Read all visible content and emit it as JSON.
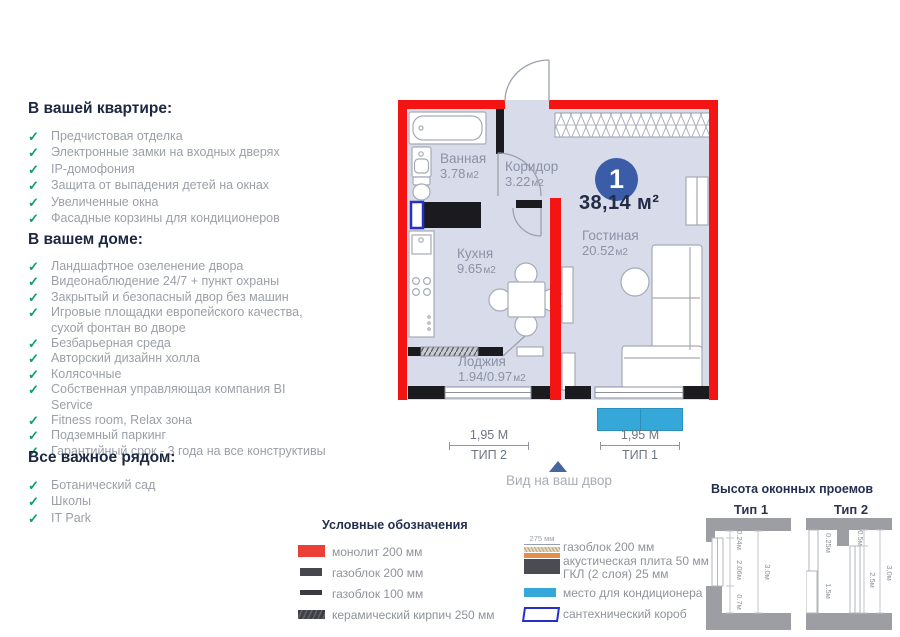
{
  "icons": {
    "check": "✓"
  },
  "colors": {
    "wall_monolith_red": "#f41414",
    "wall_gasblock_dark": "#1b1b1f",
    "floor_fill": "#d8dbea",
    "badge_blue": "#3b5da8",
    "ac_cyan": "#35a8d9",
    "plumbing_blue": "#2430c8",
    "check_green": "#0b9e68",
    "heading_navy": "#1c2742"
  },
  "sections": {
    "apartment": {
      "title": "В вашей квартире:",
      "items": [
        "Предчистовая отделка",
        "Электронные замки на входных дверях",
        "IP-домофония",
        "Защита от выпадения детей на окнах",
        "Увеличенные окна",
        "Фасадные корзины для кондиционеров"
      ]
    },
    "house": {
      "title": "В вашем доме:",
      "items": [
        "Ландшафтное озеленение двора",
        "Видеонаблюдение 24/7 + пункт охраны",
        "Закрытый и безопасный двор без машин",
        "Игровые площадки европейского качества, сухой фонтан во дворе",
        "Безбарьерная среда",
        "Авторский дизайнн холла",
        "Колясочные",
        "Собственная управляющая компания BI Service",
        "Fitness room, Relax зона",
        "Подземный паркинг",
        "Гарантийный срок - 3 года на все конструктивы"
      ]
    },
    "nearby": {
      "title": "Все важное рядом:",
      "items": [
        "Ботанический сад",
        "Школы",
        "IT Park"
      ]
    }
  },
  "plan": {
    "unit_number": "1",
    "total_area": "38,14 м²",
    "rooms": {
      "bathroom": {
        "name": "Ванная",
        "area": "3.78",
        "unit": "м2"
      },
      "corridor": {
        "name": "Коридор",
        "area": "3.22",
        "unit": "м2"
      },
      "kitchen": {
        "name": "Кухня",
        "area": "9.65",
        "unit": "м2"
      },
      "living": {
        "name": "Гостиная",
        "area": "20.52",
        "unit": "м2"
      },
      "loggia": {
        "name": "Лоджия",
        "area": "1.94/0.97",
        "unit": "м2"
      }
    },
    "dimensions": {
      "left": {
        "length": "1,95 М",
        "type": "ТИП 2"
      },
      "right": {
        "length": "1,95 М",
        "type": "ТИП 1"
      }
    },
    "view_label": "Вид на ваш двор"
  },
  "legend": {
    "title": "Условные обозначения",
    "monolith": "монолит 200 мм",
    "gasblock200": "газоблок 200 мм",
    "gasblock100": "газоблок 100 мм",
    "brick": "керамический кирпич 250 мм",
    "layered": {
      "dim": "275 мм",
      "line1": "газоблок 200 мм",
      "line2": "акустическая плита 50 мм",
      "line3": "ГКЛ (2 слоя) 25 мм"
    },
    "ac": "место для кондиционера",
    "plumbing": "сантехнический короб"
  },
  "windows": {
    "title": "Высота оконных проемов",
    "type1": {
      "label": "Тип 1",
      "m1": "0.24м",
      "m2": "2.06м",
      "m3": "0.7м",
      "m4": "3.0м"
    },
    "type2": {
      "label": "Тип 2",
      "m1": "0.25м",
      "m2": "0.5м",
      "m3": "2.5м",
      "m4": "1.5м",
      "m5": "3.0м"
    }
  }
}
